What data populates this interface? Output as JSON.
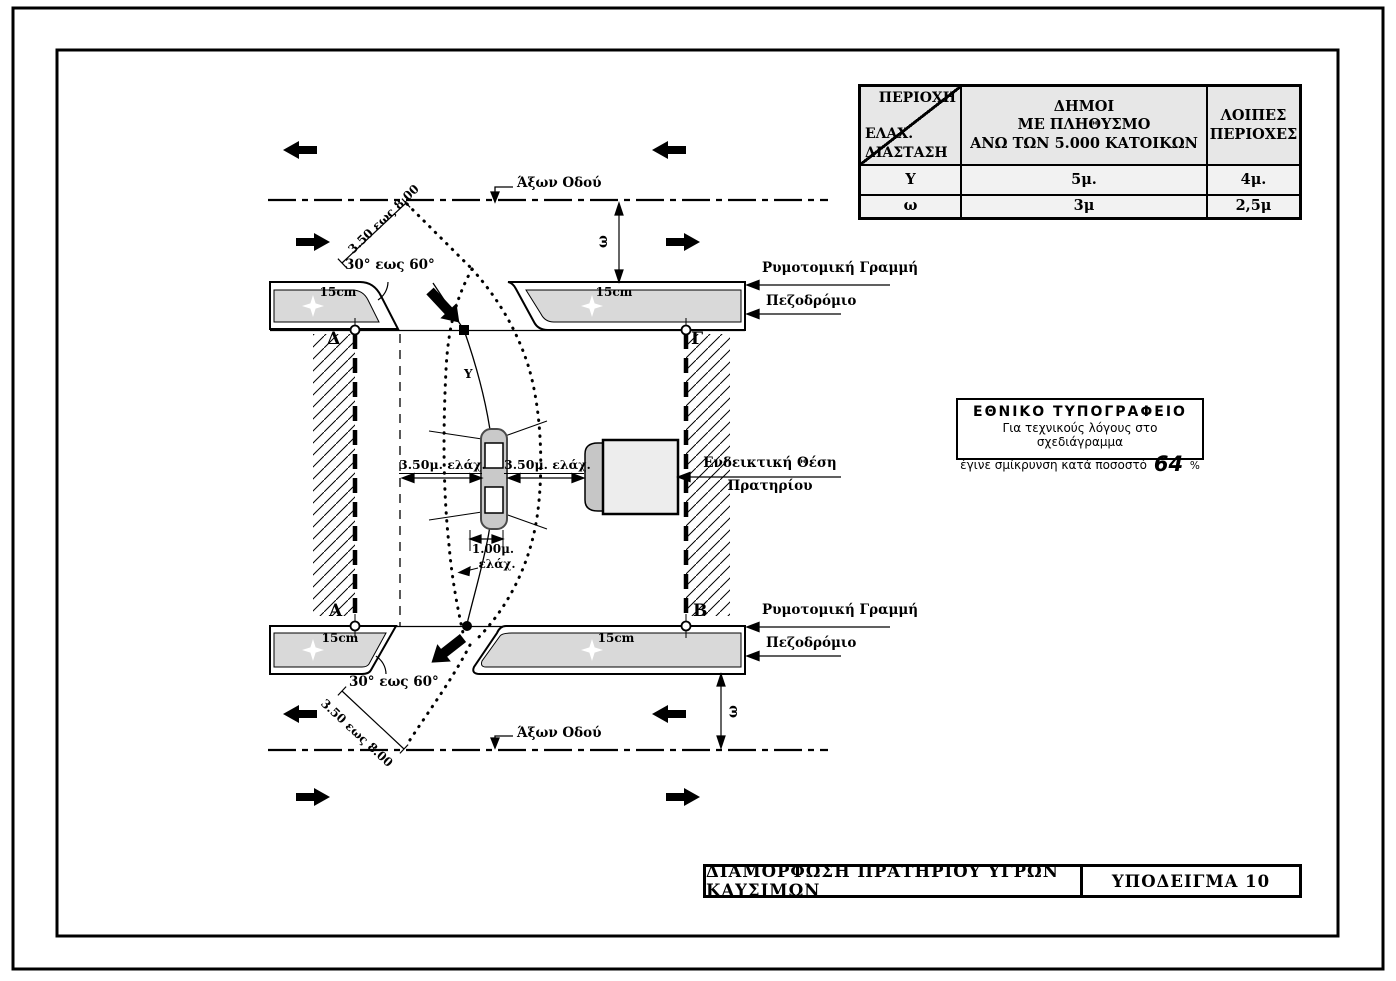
{
  "table": {
    "corner_header_top": "ΠΕΡΙΟΧΗ",
    "corner_header_bottom1": "ΕΛΑΧ.",
    "corner_header_bottom2": "ΔΙΑΣΤΑΣΗ",
    "col2_header_line1": "ΔΗΜΟΙ",
    "col2_header_line2": "ΜΕ ΠΛΗΘΥΣΜΟ",
    "col2_header_line3": "ΑΝΩ ΤΩΝ 5.000 ΚΑΤΟΙΚΩΝ",
    "col3_header_line1": "ΛΟΙΠΕΣ",
    "col3_header_line2": "ΠΕΡΙΟΧΕΣ",
    "rows": [
      {
        "dim": "Υ",
        "municipalities": "5μ.",
        "other": "4μ."
      },
      {
        "dim": "ω",
        "municipalities": "3μ",
        "other": "2,5μ"
      }
    ]
  },
  "note_box": {
    "title": "ΕΘΝΙΚΟ ΤΥΠΟΓΡΑΦΕΙΟ",
    "line1": "Για τεχνικούς λόγους στο σχεδιάγραμμα",
    "line2": "έγινε σμίκρυνση κατά ποσοστό",
    "percent_value": "64",
    "percent_sign": "%"
  },
  "title_bar": {
    "title": "ΔΙΑΜΟΡΦΩΣΗ ΠΡΑΤΗΡΙΟΥ ΥΓΡΩΝ ΚΑΥΣΙΜΩΝ",
    "doc_ref": "ΥΠΟΔΕΙΓΜΑ 10"
  },
  "labels": {
    "road_axis": "Άξων Οδού",
    "building_line": "Ρυμοτομική Γραμμή",
    "sidewalk": "Πεζοδρόμιο",
    "station_line1": "Ενδεικτική Θέση",
    "station_line2": "Πρατηρίου",
    "angle_range": "30° εως 60°",
    "diagonal_dim": "3.50 εως 8.00",
    "min_clearance_left": "3.50μ. ελάχ.",
    "min_clearance_right": "3.50μ. ελάχ.",
    "island_width": "1.00μ.",
    "min_abbrev": "ελάχ.",
    "curb_width": "15cm",
    "omega": "ω",
    "upsilon": "Υ"
  },
  "corners": {
    "top_left": "Δ",
    "top_right": "Γ",
    "bottom_left": "Α",
    "bottom_right": "Β"
  },
  "colors": {
    "line": "#000000",
    "sidewalk_gray": "#d9d9d9",
    "car_gray": "#c9c9c9",
    "pump_gray": "#ededed",
    "pump_cap_gray": "#c6c6c6",
    "table_header_bg": "#e7e7e7"
  }
}
